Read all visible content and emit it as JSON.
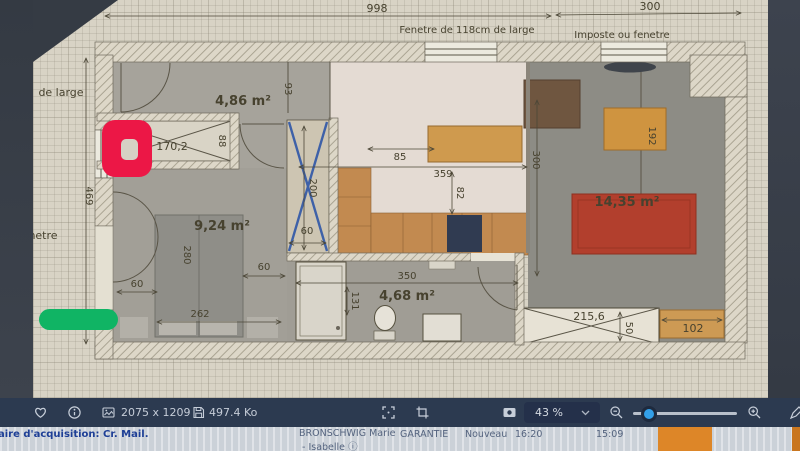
{
  "plan": {
    "dims": {
      "width_total": "998",
      "width_imposte": "300",
      "window_label": "Fenetre de 118cm de large",
      "imposte_label": "Imposte ou fenetre",
      "left_label_cut_top": "de large",
      "left_label_cut_mid": "netre",
      "height_total": "469",
      "closet_width": "170,2",
      "closet_depth": "88",
      "hall_width": "93",
      "bed_length": "280",
      "bed_width": "262",
      "bed_clearance_left": "60",
      "bed_clearance_right": "60",
      "wardrobe_depth": "200",
      "wardrobe_width": "60",
      "kitchen_clearance": "85",
      "kitchen_width": "359",
      "kitchen_depth": "82",
      "kitchen_height": "300",
      "table_length": "192",
      "bathroom_width": "350",
      "shower_width": "131",
      "bay_window_width": "215,6",
      "bay_window_depth": "50",
      "sideboard_width": "102"
    },
    "rooms": {
      "entry": "4,86 m²",
      "bedroom": "9,24 m²",
      "bathroom": "4,68 m²",
      "living": "14,35 m²"
    }
  },
  "toolbar": {
    "image_dimensions": "2075 x 1209",
    "file_size": "497.4 Ko",
    "zoom_level": "43 %"
  },
  "statusbar": {
    "subject_line": "aire d'acquisition: Cr. Mail.",
    "contact_name": "BRONSCHWIG Marie",
    "contact_name2": "- Isabelle",
    "info_glyph": "ⓘ",
    "category": "GARANTIE",
    "status": "Nouveau",
    "time_1": "16:20",
    "time_2": "15:09"
  },
  "colors": {
    "marker_red": "#ec1746",
    "marker_green": "#10b464",
    "toolbar_bg": "#2c3a50",
    "slider_thumb": "#339fe8",
    "statusbar_orange": "#dd8628",
    "rug_red": "#b23f2d",
    "wood_orange": "#c9914f",
    "wardrobe_blue": "#3e61a8"
  }
}
